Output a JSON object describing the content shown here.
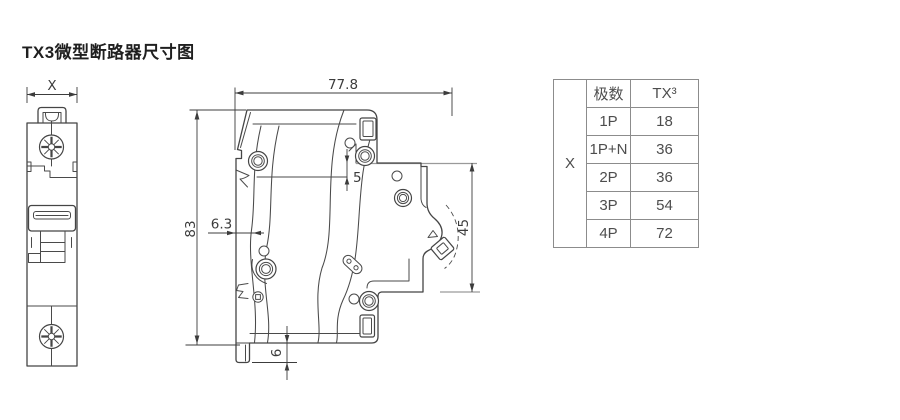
{
  "page": {
    "title": "TX3微型断路器尺寸图"
  },
  "drawing": {
    "front_view": {
      "width_label": "X"
    },
    "side_view": {
      "overall_depth": "77.8",
      "overall_height": "83",
      "rail_contour_offset": "6.3",
      "terminal_recess": "5",
      "mounting_depth": "45",
      "rail_step": "6"
    }
  },
  "table": {
    "corner_label": "X",
    "headers": [
      "极数",
      "TX³"
    ],
    "rows": [
      {
        "poles": "1P",
        "value": "18"
      },
      {
        "poles": "1P+N",
        "value": "36"
      },
      {
        "poles": "2P",
        "value": "36"
      },
      {
        "poles": "3P",
        "value": "54"
      },
      {
        "poles": "4P",
        "value": "72"
      }
    ]
  },
  "colors": {
    "line": "#4a4a4a",
    "dimension": "#3c3c3c",
    "reference_line": "#9a9a9a",
    "table_border": "#8c8c8c",
    "table_text": "#4d4d4d",
    "title_text": "#1f1f1f"
  }
}
